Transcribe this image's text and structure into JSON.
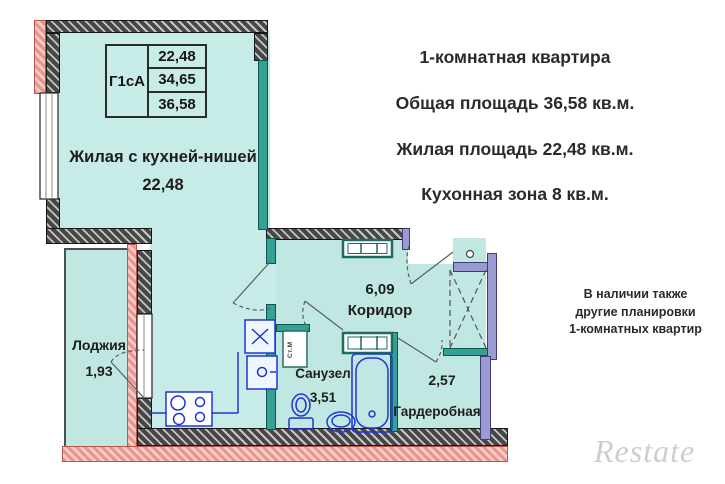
{
  "info_panel": {
    "title": "1-комнатная квартира",
    "total_area": "Общая площадь 36,58 кв.м.",
    "living_area": "Жилая площадь 22,48 кв.м.",
    "kitchen_zone": "Кухонная зона 8 кв.м.",
    "availability": [
      "В наличии также",
      "другие планировки",
      "1-комнатных квартир"
    ],
    "watermark": "Restate"
  },
  "plan": {
    "type_table": {
      "type_code": "Г1сА",
      "row1": "22,48",
      "row2": "34,65",
      "row3": "36,58"
    },
    "rooms": {
      "living": {
        "name": "Жилая с кухней-нишей",
        "area": "22,48"
      },
      "loggia": {
        "name": "Лоджия",
        "area": "1,93"
      },
      "corridor": {
        "name": "Коридор",
        "area": "6,09"
      },
      "bathroom": {
        "name": "Санузел",
        "area": "3,51"
      },
      "wardrobe": {
        "name": "Гардеробная",
        "area": "2,57"
      }
    },
    "washing_machine_label": "Ст.М"
  },
  "colors": {
    "room_fill": "#c7ebe6",
    "partition_teal": "#35a094",
    "wall_purple": "#9a9bd0",
    "wall_pink": "#f6cbc6",
    "wall_gray": "#474747",
    "fixture_blue": "#2135d6"
  }
}
